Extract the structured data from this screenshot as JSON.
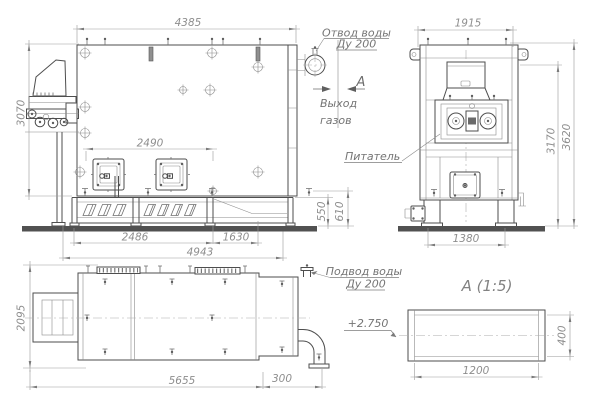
{
  "side_view": {
    "dims": {
      "width": "4385",
      "height": "3070",
      "doors_span": "2490",
      "base_left": "2486",
      "base_right": "1630",
      "base_total": "4943",
      "outlet_height": "550",
      "frame_height": "610"
    },
    "labels": {
      "water_outlet_1": "Отвод воды",
      "water_outlet_2": "Ду 200",
      "section_letter": "А",
      "gas_outlet_1": "Выход",
      "gas_outlet_2": "газов"
    }
  },
  "front_view": {
    "dims": {
      "width": "1915",
      "height_partial": "3170",
      "height_total": "3620",
      "base_width": "1380"
    },
    "labels": {
      "feeder": "Питатель"
    }
  },
  "top_view": {
    "dims": {
      "width": "2095",
      "length": "5655",
      "pipe_stub": "300"
    },
    "labels": {
      "water_inlet_1": "Подвод воды",
      "water_inlet_2": "Ду 200"
    }
  },
  "section_view": {
    "title": "А  (1:5)",
    "elevation": "+2.750",
    "dims": {
      "length": "1200",
      "height": "400"
    }
  }
}
